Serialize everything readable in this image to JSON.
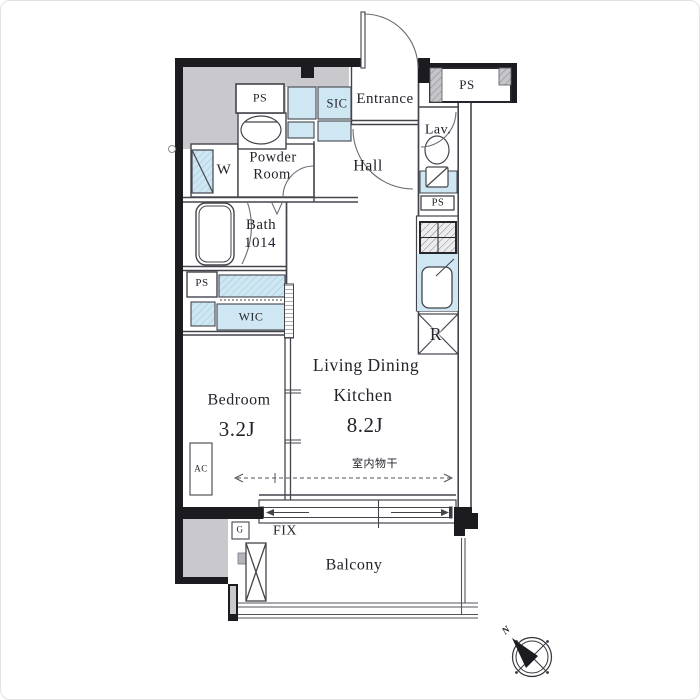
{
  "document": {
    "kind": "apartment floor plan"
  },
  "colors": {
    "accent_blue": "#cfe7f2",
    "shade_gray": "#c9c9cd",
    "wall_black": "#1b1b20",
    "line": "#44444c"
  },
  "labels": {
    "entrance": "Entrance",
    "sic": "SIC",
    "hall": "Hall",
    "lav": "Lav.",
    "powder_1": "Powder",
    "powder_2": "Room",
    "washer": "W",
    "bath_1": "Bath",
    "bath_2": "1014",
    "wic": "WIC",
    "bedroom": "Bedroom",
    "bedroom_size": "3.2J",
    "ldk_1": "Living Dining",
    "ldk_2": "Kitchen",
    "ldk_size": "8.2J",
    "refrigerator": "R",
    "ac": "AC",
    "gas": "G",
    "fix": "FIX",
    "indoor_drying": "室内物干",
    "balcony": "Balcony",
    "north": "N",
    "ps_top_left": "PS",
    "ps_top_right": "PS",
    "ps_lav": "PS",
    "ps_wic": "PS"
  }
}
